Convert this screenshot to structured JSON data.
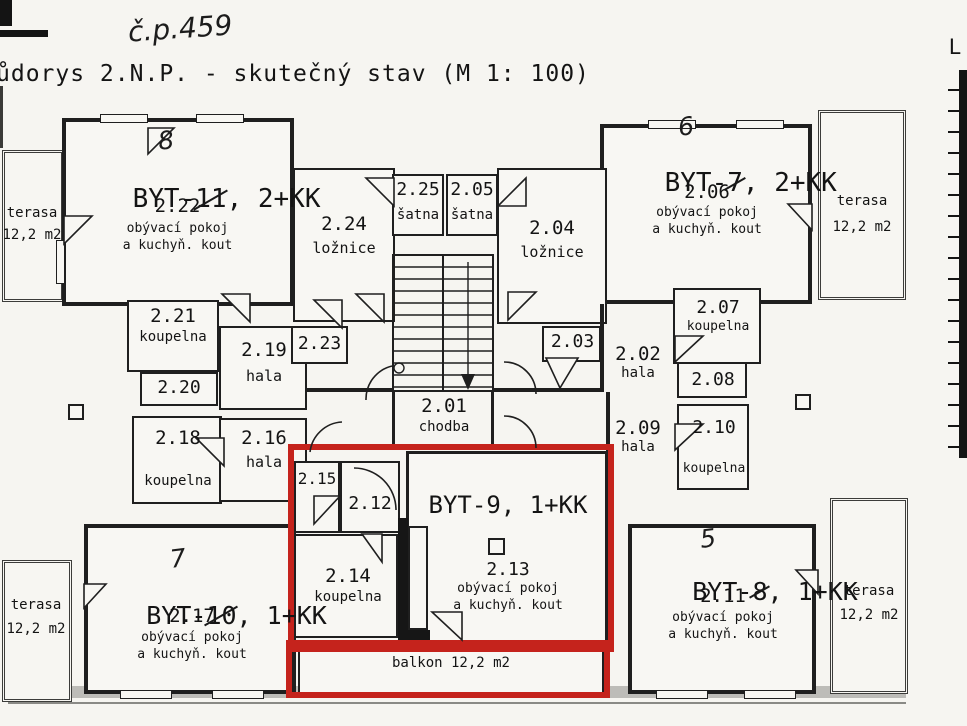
{
  "meta": {
    "title": "ůdorys 2.N.P. - skutečný stav (M 1: 100)",
    "handwritten_house_number": "č.p.459"
  },
  "legend": {
    "letter": "L"
  },
  "apartments": {
    "byt11": {
      "prefix": "BYT-",
      "old_no": "11",
      "rest": ", 2+KK",
      "hand": "8"
    },
    "byt7": {
      "prefix": "BYT-",
      "old_no": "7",
      "rest": ", 2+KK",
      "hand": "6"
    },
    "byt9": {
      "title": "BYT-9, 1+KK"
    },
    "byt10": {
      "prefix": "BYT-",
      "old_no": "10",
      "rest": ", 1+KK",
      "hand": "7"
    },
    "byt8": {
      "prefix": "BYT-",
      "old_no": "8",
      "rest": ", 1+KK",
      "hand": "5"
    }
  },
  "rooms": {
    "r201": {
      "num": "2.01",
      "name": "chodba"
    },
    "r202": {
      "num": "2.02",
      "name": "hala"
    },
    "r203": {
      "num": "2.03"
    },
    "r204": {
      "num": "2.04",
      "name": "ložnice"
    },
    "r205": {
      "num": "2.05",
      "name": "šatna"
    },
    "r206": {
      "num": "2.06",
      "l1": "obývací pokoj",
      "l2": "a kuchyň. kout"
    },
    "r207": {
      "num": "2.07",
      "name": "koupelna"
    },
    "r208": {
      "num": "2.08"
    },
    "r209": {
      "num": "2.09",
      "name": "hala"
    },
    "r210": {
      "num": "2.10",
      "name": "koupelna"
    },
    "r211": {
      "num": "2.11",
      "l1": "obývací pokoj",
      "l2": "a kuchyň. kout"
    },
    "r212": {
      "num": "2.12"
    },
    "r213": {
      "num": "2.13",
      "l1": "obývací pokoj",
      "l2": "a kuchyň. kout"
    },
    "r214": {
      "num": "2.14",
      "name": "koupelna"
    },
    "r215": {
      "num": "2.15"
    },
    "r216": {
      "num": "2.16",
      "name": "hala"
    },
    "r217": {
      "num": "2.17",
      "l1": "obývací pokoj",
      "l2": "a kuchyň. kout"
    },
    "r218": {
      "num": "2.18",
      "name": "koupelna"
    },
    "r219": {
      "num": "2.19",
      "name": "hala"
    },
    "r220": {
      "num": "2.20"
    },
    "r221": {
      "num": "2.21",
      "name": "koupelna"
    },
    "r222": {
      "num": "2.22",
      "l1": "obývací pokoj",
      "l2": "a kuchyň. kout"
    },
    "r223": {
      "num": "2.23"
    },
    "r224": {
      "num": "2.24",
      "name": "ložnice"
    },
    "r225": {
      "num": "2.25",
      "name": "šatna"
    }
  },
  "terraces": {
    "tl": {
      "name": "terasa",
      "area": "12,2 m2"
    },
    "tr": {
      "name": "terasa",
      "area": "12,2 m2"
    },
    "bl": {
      "name": "terasa",
      "area": "12,2 m2"
    },
    "br": {
      "name": "terasa",
      "area": "12,2 m2"
    }
  },
  "balcony": {
    "label": "balkon 12,2 m2"
  },
  "colors": {
    "highlight_red": "#c5231c",
    "paper": "#f6f5f1",
    "ink": "#1f1f1f"
  }
}
